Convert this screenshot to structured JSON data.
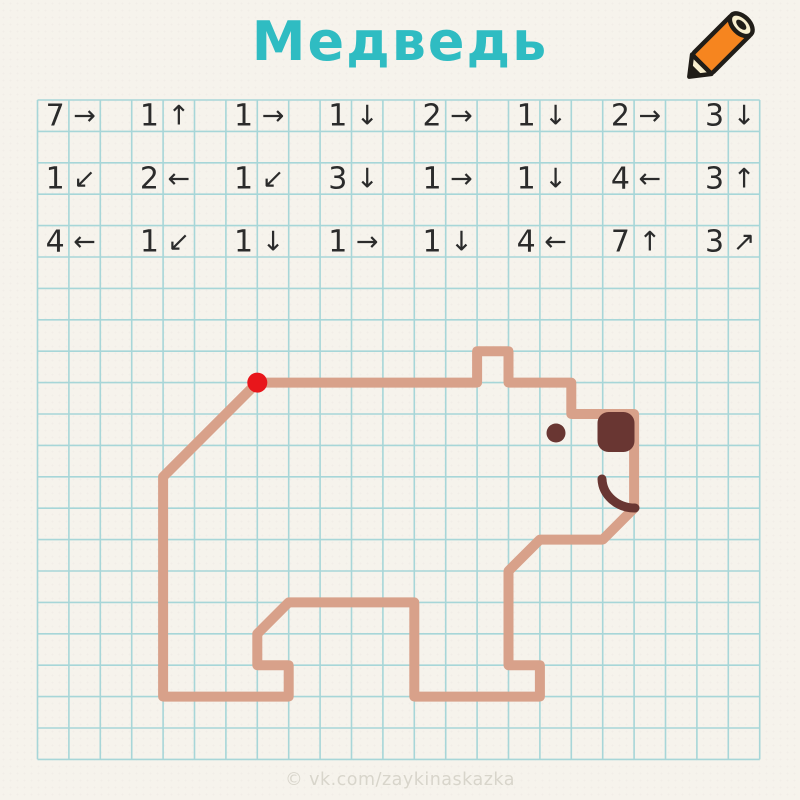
{
  "title": "Медведь",
  "watermark": "© vk.com/zaykinaskazka",
  "colors": {
    "background": "#f6f3ec",
    "title": "#2fbcc2",
    "grid_line": "#a7d6d8",
    "bear_outline": "#d8a18a",
    "start_dot": "#e8161b",
    "feature_dark": "#693632",
    "instruction_text": "#2b2b2b",
    "watermark_text": "#d8d5cb",
    "pencil_orange": "#f6851f",
    "pencil_cream": "#f8efcf",
    "pencil_dark": "#201d18"
  },
  "grid": {
    "origin_x": 37.5,
    "origin_y": 100,
    "cell": 31.4,
    "cols": 23,
    "rows": 21,
    "line_width": 1.6
  },
  "instructions": {
    "rows": [
      {
        "grid_row": 0,
        "steps": [
          {
            "count": "7",
            "arrow": "→",
            "arrow_name": "right-arrow"
          },
          {
            "count": "1",
            "arrow": "↑",
            "arrow_name": "up-arrow"
          },
          {
            "count": "1",
            "arrow": "→",
            "arrow_name": "right-arrow"
          },
          {
            "count": "1",
            "arrow": "↓",
            "arrow_name": "down-arrow"
          },
          {
            "count": "2",
            "arrow": "→",
            "arrow_name": "right-arrow"
          },
          {
            "count": "1",
            "arrow": "↓",
            "arrow_name": "down-arrow"
          },
          {
            "count": "2",
            "arrow": "→",
            "arrow_name": "right-arrow"
          },
          {
            "count": "3",
            "arrow": "↓",
            "arrow_name": "down-arrow"
          }
        ]
      },
      {
        "grid_row": 2,
        "steps": [
          {
            "count": "1",
            "arrow": "↙",
            "arrow_name": "down-left-arrow"
          },
          {
            "count": "2",
            "arrow": "←",
            "arrow_name": "left-arrow"
          },
          {
            "count": "1",
            "arrow": "↙",
            "arrow_name": "down-left-arrow"
          },
          {
            "count": "3",
            "arrow": "↓",
            "arrow_name": "down-arrow"
          },
          {
            "count": "1",
            "arrow": "→",
            "arrow_name": "right-arrow"
          },
          {
            "count": "1",
            "arrow": "↓",
            "arrow_name": "down-arrow"
          },
          {
            "count": "4",
            "arrow": "←",
            "arrow_name": "left-arrow"
          },
          {
            "count": "3",
            "arrow": "↑",
            "arrow_name": "up-arrow"
          }
        ]
      },
      {
        "grid_row": 4,
        "steps": [
          {
            "count": "4",
            "arrow": "←",
            "arrow_name": "left-arrow"
          },
          {
            "count": "1",
            "arrow": "↙",
            "arrow_name": "down-left-arrow"
          },
          {
            "count": "1",
            "arrow": "↓",
            "arrow_name": "down-arrow"
          },
          {
            "count": "1",
            "arrow": "→",
            "arrow_name": "right-arrow"
          },
          {
            "count": "1",
            "arrow": "↓",
            "arrow_name": "down-arrow"
          },
          {
            "count": "4",
            "arrow": "←",
            "arrow_name": "left-arrow"
          },
          {
            "count": "7",
            "arrow": "↑",
            "arrow_name": "up-arrow"
          },
          {
            "count": "3",
            "arrow": "↗",
            "arrow_name": "up-right-arrow"
          }
        ]
      }
    ]
  },
  "drawing": {
    "stroke_width": 10,
    "start_dot": {
      "col": 7,
      "row": 9,
      "radius": 10
    },
    "path_vertices": [
      [
        7,
        9
      ],
      [
        14,
        9
      ],
      [
        14,
        8
      ],
      [
        15,
        8
      ],
      [
        15,
        9
      ],
      [
        17,
        9
      ],
      [
        17,
        10
      ],
      [
        19,
        10
      ],
      [
        19,
        13
      ],
      [
        18,
        14
      ],
      [
        16,
        14
      ],
      [
        15,
        15
      ],
      [
        15,
        18
      ],
      [
        16,
        18
      ],
      [
        16,
        19
      ],
      [
        12,
        19
      ],
      [
        12,
        16
      ],
      [
        8,
        16
      ],
      [
        7,
        17
      ],
      [
        7,
        18
      ],
      [
        8,
        18
      ],
      [
        8,
        19
      ],
      [
        4,
        19
      ],
      [
        4,
        12
      ]
    ],
    "closed": true,
    "eye": {
      "cx": 556,
      "cy": 433,
      "r": 9.5
    },
    "nose": {
      "x": 597.5,
      "y": 412,
      "width": 37,
      "height": 40,
      "rx": 11
    },
    "mouth": {
      "x1": 602,
      "y1": 479,
      "rx": 33,
      "ry": 30,
      "x2": 635,
      "y2": 508,
      "stroke_width": 9
    }
  }
}
